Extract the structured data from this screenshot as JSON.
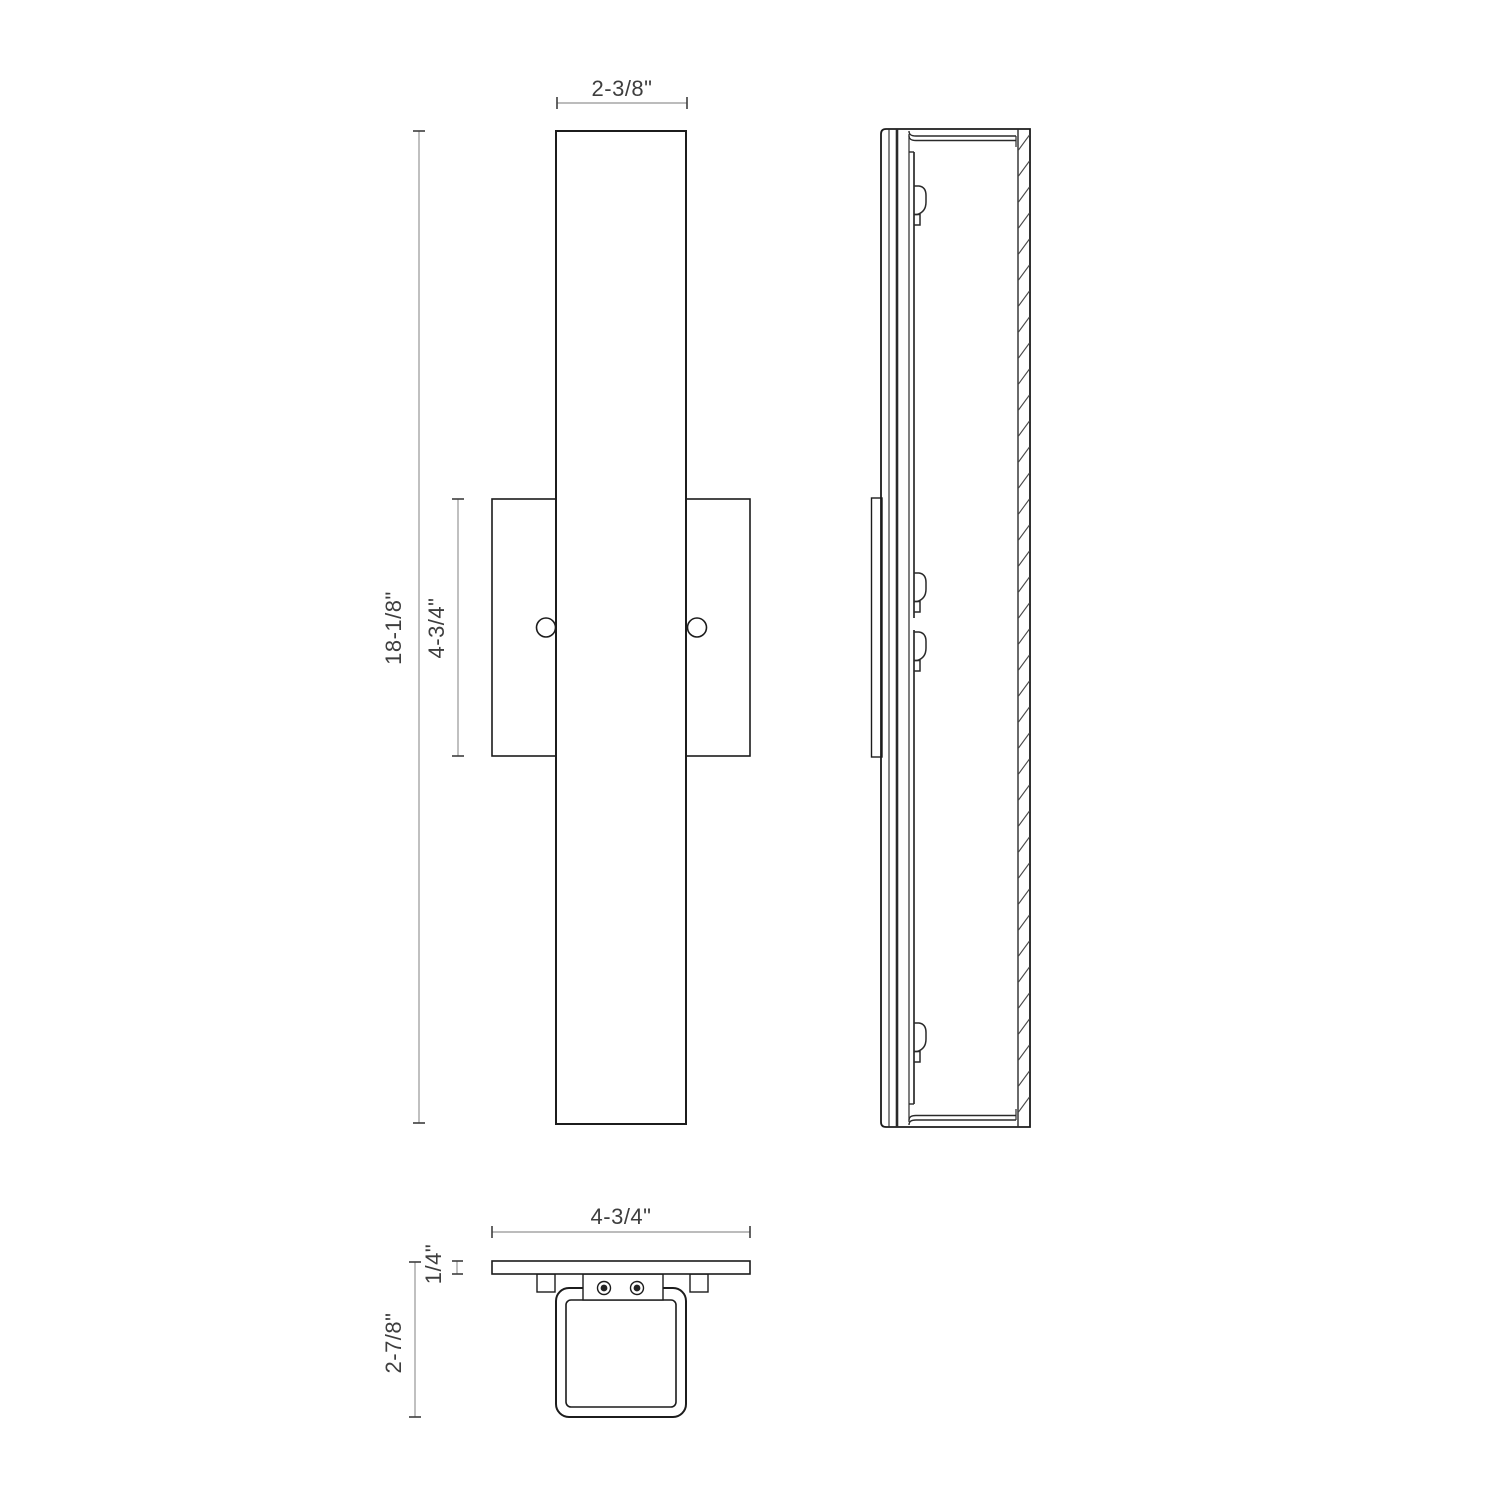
{
  "drawing": {
    "type": "technical-dimension-drawing",
    "subject": "linear wall sconce - front, side and bottom orthographic views",
    "colors": {
      "outline": "#1c1c1c",
      "dimension_line": "#a6a6a6",
      "dimension_tick": "#3e3e3e",
      "label_text": "#3e3e3e",
      "background": "#ffffff"
    },
    "front_view": {
      "width_dim": "2-3/8\"",
      "height_dim": "18-1/8\"",
      "backplate_height_dim": "4-3/4\""
    },
    "bottom_view": {
      "width_dim": "4-3/4\"",
      "plate_thickness_dim": "1/4\"",
      "overall_depth_dim": "2-7/8\""
    }
  }
}
